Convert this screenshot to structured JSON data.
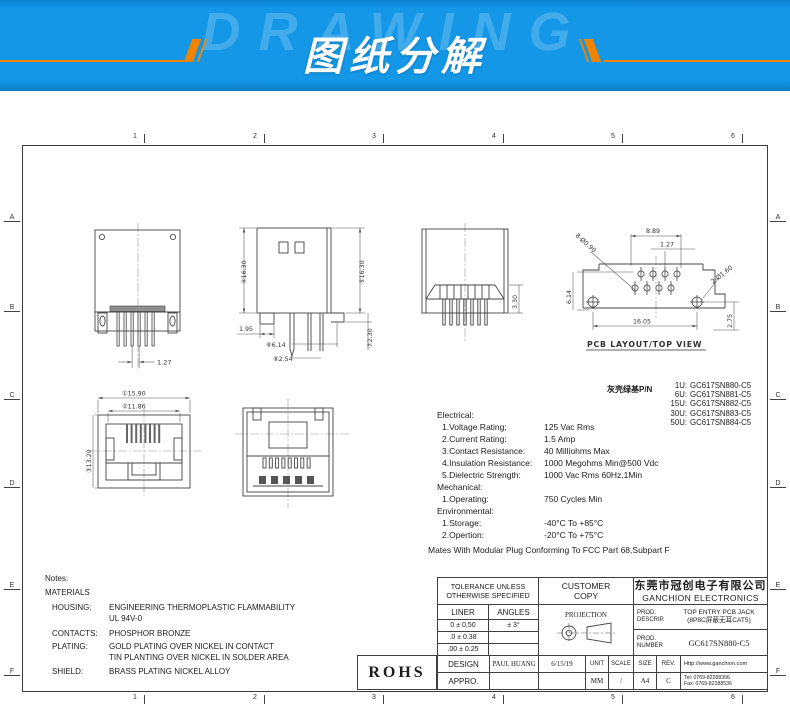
{
  "banner": {
    "watermark": "DRAWING",
    "title": "图纸分解",
    "bg_color": "#1397e6",
    "accent_color": "#f08300"
  },
  "frame": {
    "cols": [
      "1",
      "2",
      "3",
      "4",
      "5",
      "6"
    ],
    "rows": [
      "A",
      "B",
      "C",
      "D",
      "E",
      "F"
    ]
  },
  "views": {
    "rear": {
      "pitch": "1.27"
    },
    "side": {
      "h1": "④16.30",
      "h2": "⑤16.30",
      "base": "1.95",
      "d614": "⑥6.14",
      "d254": "⑧2.54",
      "d230": "⑦2.30"
    },
    "front": {
      "d330": "3.30"
    },
    "pcb": {
      "d889": "8.89",
      "d127": "1.27",
      "holes8": "8-Ø0.90",
      "d614": "6.14",
      "holes2": "2-Ø1.60",
      "d1605": "16.05",
      "d275": "2.75",
      "caption": "PCB LAYOUT/TOP VIEW"
    },
    "face": {
      "d1590": "①15.90",
      "d1186": "②11.86",
      "d1320": "③13.20"
    }
  },
  "pn_block": {
    "label": "灰壳绿基P/N",
    "items": [
      {
        "u": "1U:",
        "pn": "GC617SN880-C5"
      },
      {
        "u": "6U:",
        "pn": "GC617SN881-C5"
      },
      {
        "u": "15U:",
        "pn": "GC617SN882-C5"
      },
      {
        "u": "30U:",
        "pn": "GC617SN883-C5"
      },
      {
        "u": "50U:",
        "pn": "GC617SN884-C5"
      }
    ]
  },
  "specs": {
    "electrical_title": "Electrical:",
    "electrical": [
      {
        "label": "1.Voltage Rating:",
        "value": "125 Vac Rms"
      },
      {
        "label": "2.Current Rating:",
        "value": "1.5 Amp"
      },
      {
        "label": "3.Contact Resistance:",
        "value": "40 Milliohms Max"
      },
      {
        "label": "4.Insulation Resistance:",
        "value": "1000 Megohms Min@500 Vdc"
      },
      {
        "label": "5.Dielectric Strength:",
        "value": "1000 Vac Rms 60Hz,1Min"
      }
    ],
    "mechanical_title": "Mechanical:",
    "mechanical": [
      {
        "label": "1.Operating:",
        "value": "750 Cycles Min"
      }
    ],
    "environmental_title": "Environmental:",
    "environmental": [
      {
        "label": "1.Storage:",
        "value": "-40°C To +85°C"
      },
      {
        "label": "2.Opertion:",
        "value": "-20°C To +75°C"
      }
    ],
    "mates_note": "Mates With Modular Plug Conforming To FCC Part 68,Subpart F"
  },
  "notes": {
    "title": "Notes:",
    "materials_title": "MATERIALS",
    "housing_label": "HOUSING:",
    "housing_value1": "ENGINEERING THERMOPLASTIC FLAMMABILITY",
    "housing_value2": "UL 94V-0",
    "contacts_label": "CONTACTS:",
    "contacts_value": "PHOSPHOR BRONZE",
    "plating_label": "PLATING:",
    "plating_value1": "GOLD PLATING OVER NICKEL IN CONTACT",
    "plating_value2": "TIN PLANTING OVER NICKEL IN SOLDER AREA",
    "shield_label": "SHIELD:",
    "shield_value": "BRASS PLATING NICKEL ALLOY"
  },
  "titleblock": {
    "tolerance_header_1": "TOLERANCE UNLESS",
    "tolerance_header_2": "OTHERWISE SPECIFIED",
    "customer_copy_1": "CUSTOMER",
    "customer_copy_2": "COPY",
    "company_cn": "东莞市冠创电子有限公司",
    "company_en": "GANCHION ELECTRONICS",
    "liner": "LINER",
    "angles": "ANGLES",
    "tol_rows": [
      [
        "0 ± 0.50",
        "± 3°"
      ],
      [
        ".0 ± 0.38",
        ""
      ],
      [
        ".00 ± 0.25",
        ""
      ]
    ],
    "projection": "PROJECTION",
    "descrip_label_1": "PROD.",
    "descrip_label_2": "DESCRIP.",
    "descrip_value_1": "TOP ENTRY PCB JACK",
    "descrip_value_2": "(8P8C屏蔽无耳CAT5)",
    "number_label_1": "PROD.",
    "number_label_2": "NUMBER",
    "number_value": "GC617SN880-C5",
    "rohs": "ROHS",
    "design_label": "DESIGN",
    "appro_label": "APPRO.",
    "designer": "PAUL HUANG",
    "date": "6/15/19",
    "unit_label": "UNIT",
    "unit_value": "MM",
    "scale_label": "SCALE",
    "scale_value": "/",
    "size_label": "SIZE",
    "size_value": "A4",
    "rev_label": "REV.",
    "rev_value": "C",
    "web": "Http://www.ganchion.com",
    "tel": "Tel:  0769-82288306",
    "fax": "Fax:  0769-82288536"
  }
}
